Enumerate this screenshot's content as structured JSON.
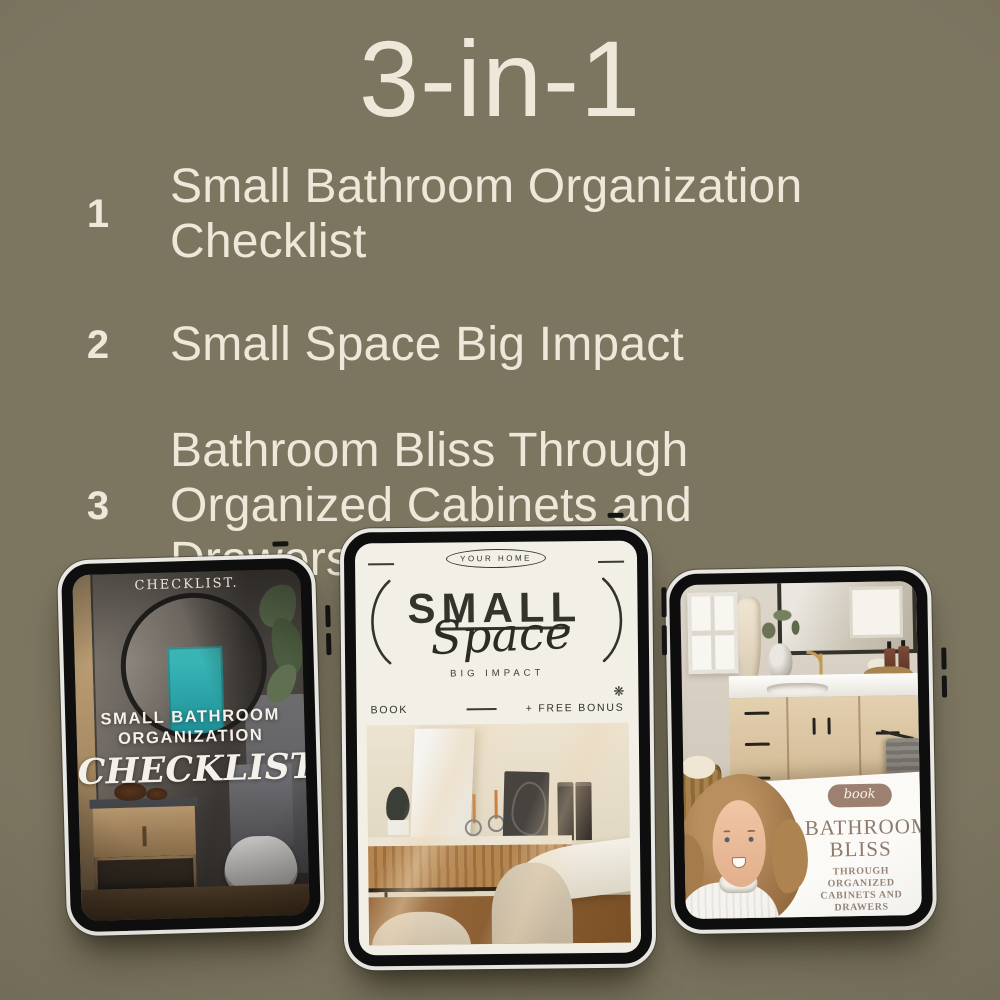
{
  "header": {
    "title": "3-in-1"
  },
  "features": [
    {
      "number": "1",
      "label": "Small Bathroom Organization Checklist"
    },
    {
      "number": "2",
      "label": "Small Space Big Impact"
    },
    {
      "number": "3",
      "label": "Bathroom Bliss Through Organized Cabinets and Drawers"
    }
  ],
  "tablets": {
    "checklist": {
      "eyebrow": "CHECKLIST.",
      "title_line1": "SMALL BATHROOM",
      "title_line2": "ORGANIZATION",
      "script_title": "CHECKLIST"
    },
    "small_space": {
      "top_badge": "YOUR HOME",
      "title": "SMALL",
      "script_title": "Space",
      "subtitle": "BIG IMPACT",
      "footer_left": "BOOK",
      "footer_right": "+ FREE BONUS",
      "footer_icon": "❋"
    },
    "bathroom_bliss": {
      "badge": "book",
      "title_line1": "BATHROOM",
      "title_line2": "BLISS",
      "subtitle_line1": "THROUGH ORGANIZED",
      "subtitle_line2": "CABINETS AND DRAWERS"
    }
  },
  "colors": {
    "background": "#7c7560",
    "text_cream": "#ede8d9",
    "accent_teal": "#2fb3b5",
    "badge_brown": "#9c8171",
    "title_brown": "#8c7a6c"
  }
}
